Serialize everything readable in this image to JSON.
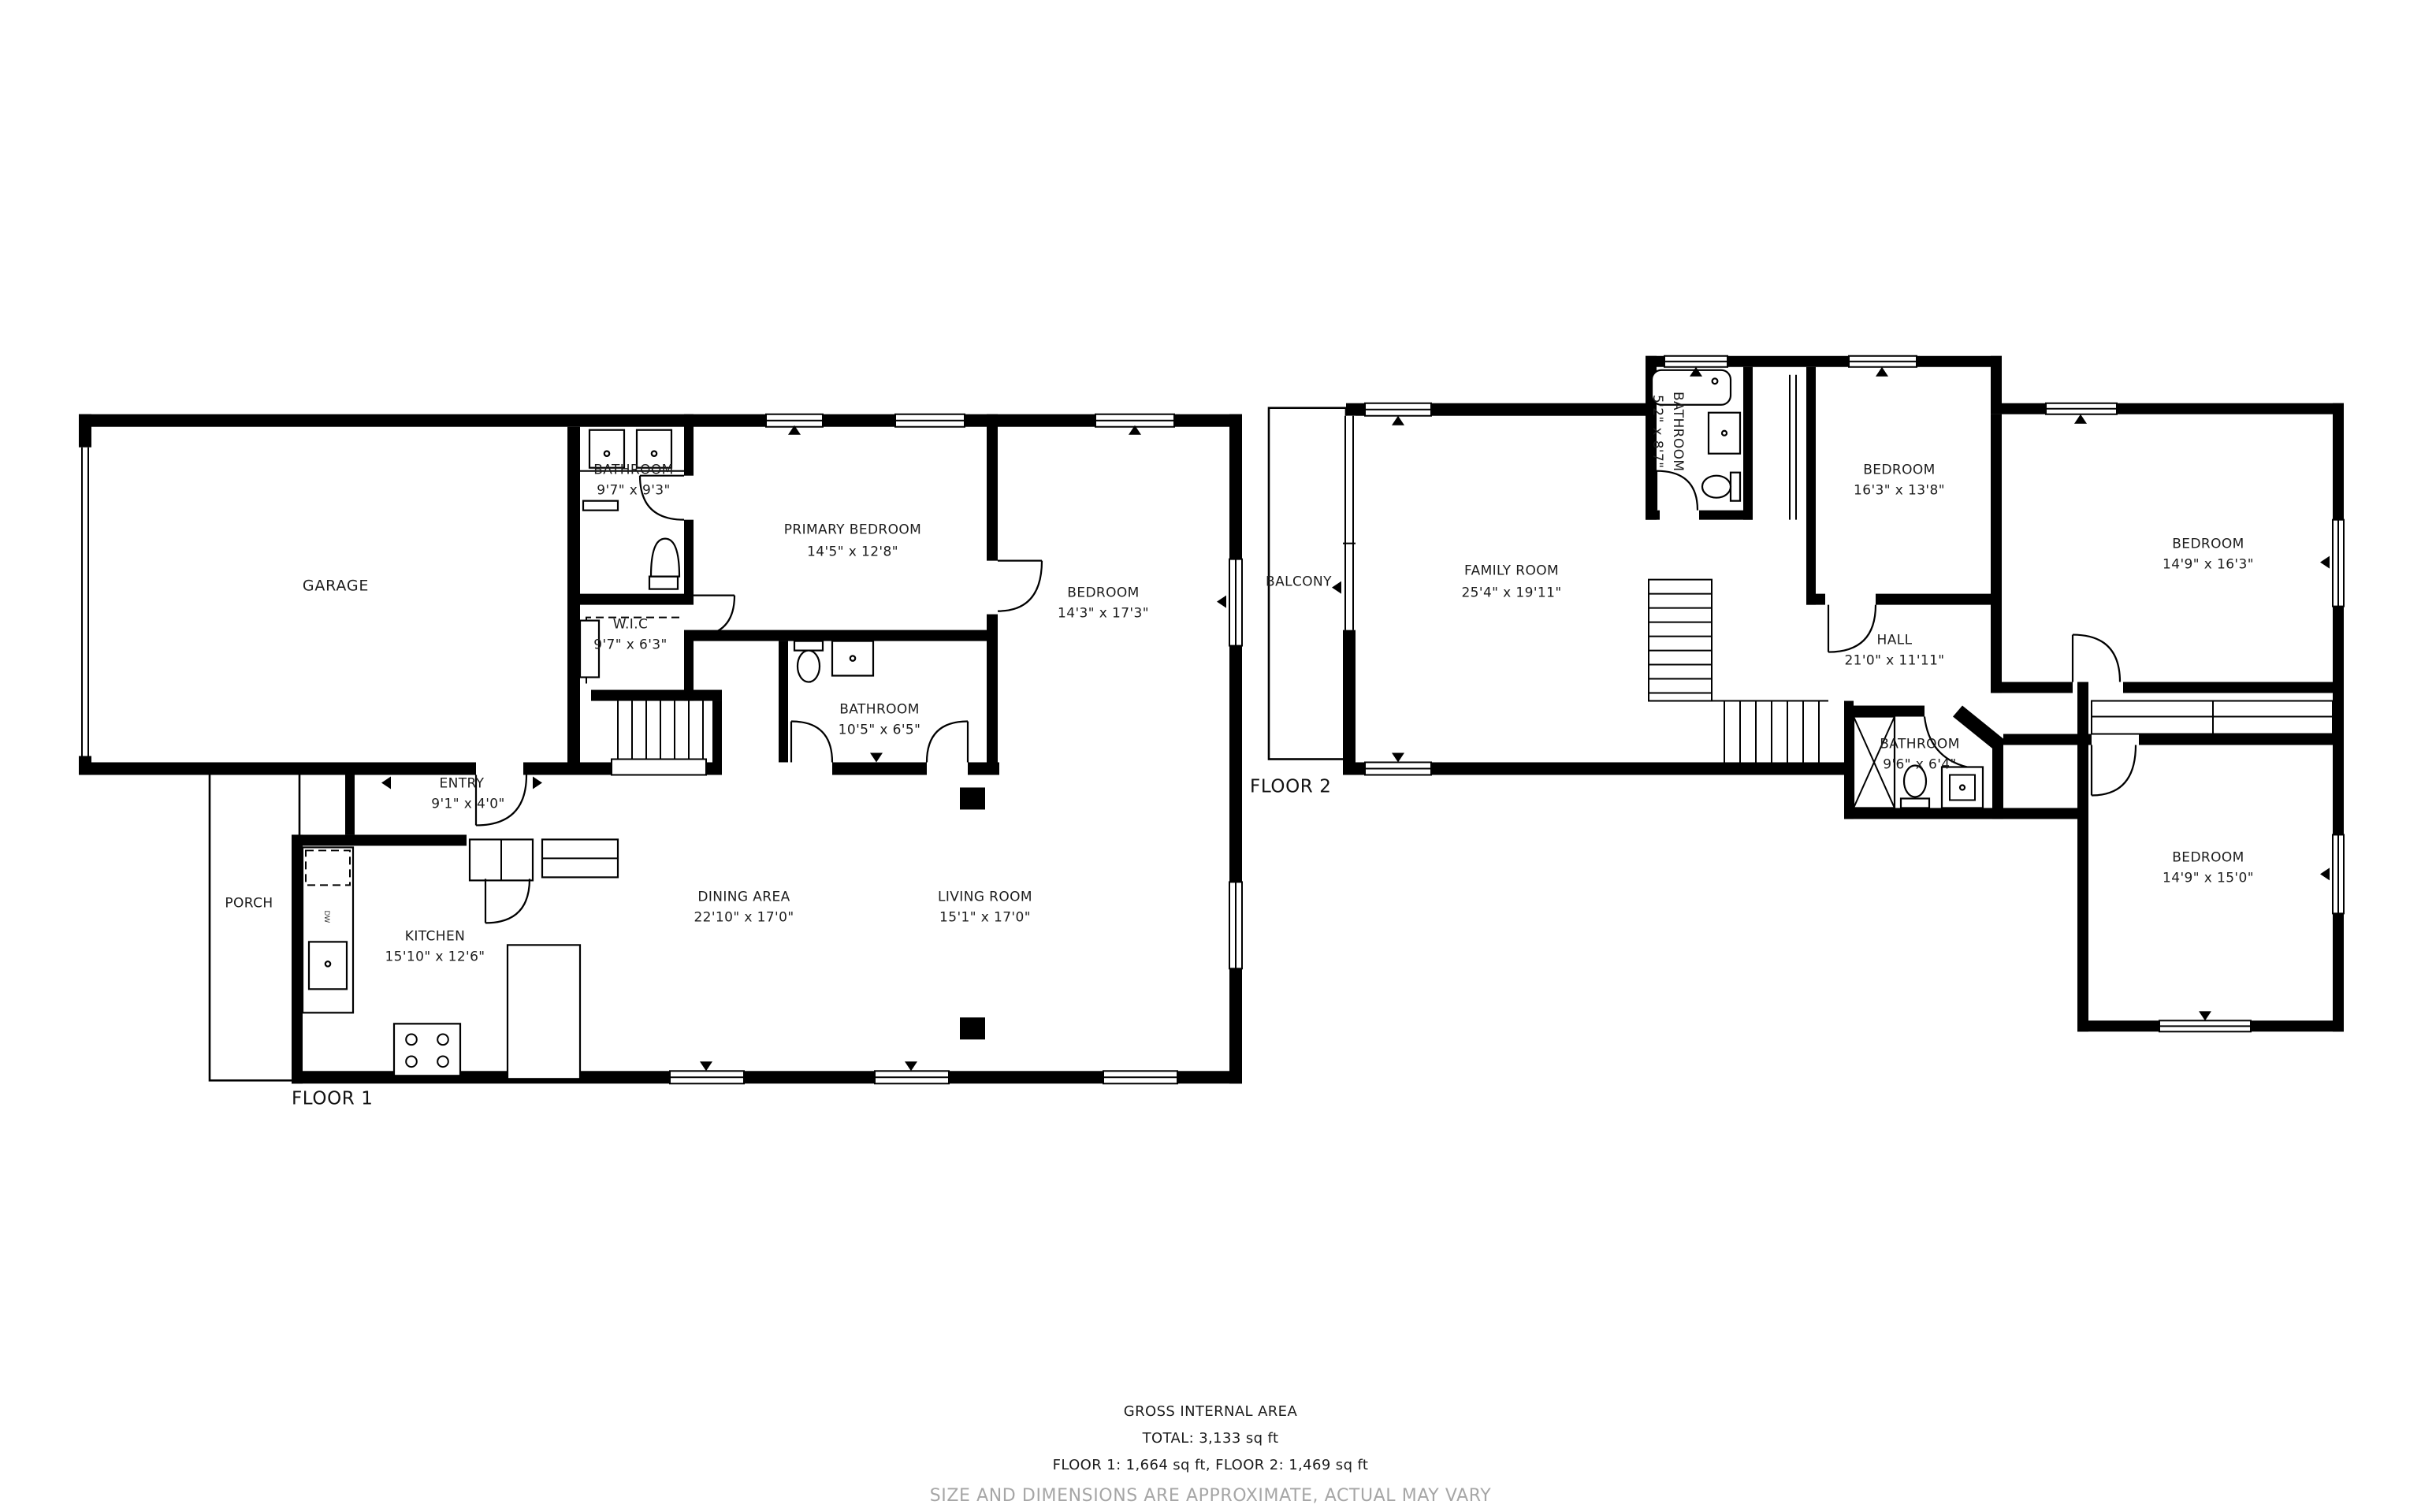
{
  "floor1": {
    "caption": "FLOOR 1",
    "garage": {
      "name": "GARAGE"
    },
    "bathroom_top": {
      "name": "BATHROOM",
      "dims": "9'7\" x 9'3\""
    },
    "primary_bedroom": {
      "name": "PRIMARY BEDROOM",
      "dims": "14'5\" x 12'8\""
    },
    "bedroom": {
      "name": "BEDROOM",
      "dims": "14'3\" x 17'3\""
    },
    "wic": {
      "name": "W.I.C",
      "dims": "9'7\" x 6'3\""
    },
    "bathroom_mid": {
      "name": "BATHROOM",
      "dims": "10'5\" x 6'5\""
    },
    "entry": {
      "name": "ENTRY",
      "dims": "9'1\" x 4'0\""
    },
    "porch": {
      "name": "PORCH"
    },
    "kitchen": {
      "name": "KITCHEN",
      "dims": "15'10\" x 12'6\"",
      "appliance": "DW"
    },
    "dining": {
      "name": "DINING AREA",
      "dims": "22'10\" x 17'0\""
    },
    "living": {
      "name": "LIVING ROOM",
      "dims": "15'1\" x 17'0\""
    }
  },
  "floor2": {
    "caption": "FLOOR 2",
    "balcony": {
      "name": "BALCONY"
    },
    "family": {
      "name": "FAMILY ROOM",
      "dims": "25'4\" x 19'11\""
    },
    "bathroom_small": {
      "name": "BATHROOM",
      "dims": "5'2\" x 8'7\""
    },
    "bedroom_a": {
      "name": "BEDROOM",
      "dims": "16'3\" x 13'8\""
    },
    "bedroom_b": {
      "name": "BEDROOM",
      "dims": "14'9\" x 16'3\""
    },
    "hall": {
      "name": "HALL",
      "dims": "21'0\" x 11'11\""
    },
    "bathroom": {
      "name": "BATHROOM",
      "dims": "9'6\" x 6'4\""
    },
    "bedroom_c": {
      "name": "BEDROOM",
      "dims": "14'9\" x 15'0\""
    }
  },
  "footer": {
    "line1": "GROSS INTERNAL AREA",
    "line2": "TOTAL: 3,133 sq ft",
    "line3": "FLOOR 1: 1,664 sq ft, FLOOR 2: 1,469 sq ft",
    "line4": "SIZE AND DIMENSIONS ARE APPROXIMATE, ACTUAL MAY VARY"
  },
  "colors": {
    "wall": "#000000",
    "text": "#1c1c1c",
    "muted": "#a6a6a6",
    "background": "#ffffff"
  }
}
